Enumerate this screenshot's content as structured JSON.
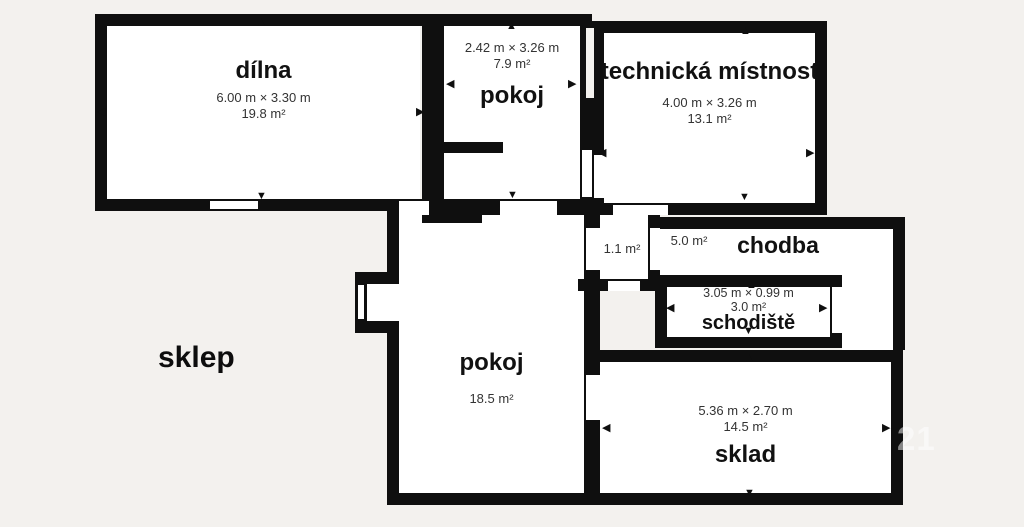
{
  "title": "sklep",
  "watermark": "21",
  "colors": {
    "background": "#f3f1ee",
    "wall": "#0f0f0f",
    "floor": "#ffffff",
    "text_primary": "#111111",
    "text_secondary": "#333333",
    "watermark": "rgba(255,255,255,0.5)"
  },
  "icons": {
    "up": "▲",
    "down": "▼",
    "left": "◀",
    "right": "▶"
  },
  "rooms": {
    "dilna": {
      "name": "dílna",
      "dims": "6.00 m × 3.30 m",
      "area": "19.8 m²"
    },
    "pokoj_top": {
      "name": "pokoj",
      "dims": "2.42 m × 3.26 m",
      "area": "7.9 m²"
    },
    "technicka": {
      "name": "technická místnost",
      "dims": "4.00 m × 3.26 m",
      "area": "13.1 m²"
    },
    "mala": {
      "area": "1.1 m²"
    },
    "chodba": {
      "name": "chodba",
      "area": "5.0 m²"
    },
    "schodiste": {
      "name": "schodiště",
      "dims": "3.05 m × 0.99 m",
      "area": "3.0 m²"
    },
    "pokoj_dolni": {
      "name": "pokoj",
      "area": "18.5 m²"
    },
    "sklad": {
      "name": "sklad",
      "dims": "5.36 m × 2.70 m",
      "area": "14.5 m²"
    }
  }
}
